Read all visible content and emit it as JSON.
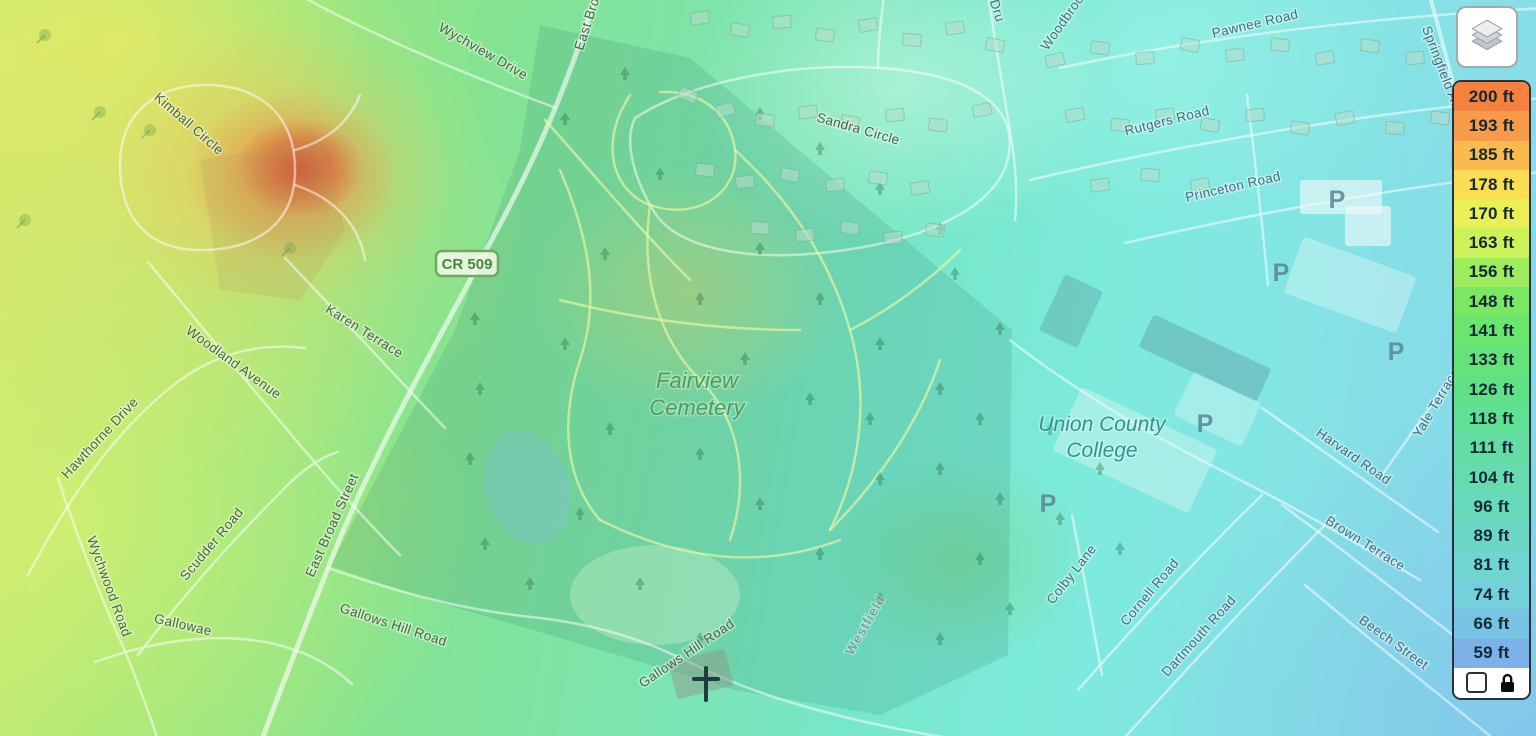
{
  "legend": {
    "unit": "ft",
    "items": [
      {
        "label": "200 ft",
        "color": "#f5813f"
      },
      {
        "label": "193 ft",
        "color": "#f79a49"
      },
      {
        "label": "185 ft",
        "color": "#f9bb4e"
      },
      {
        "label": "178 ft",
        "color": "#fadd52"
      },
      {
        "label": "170 ft",
        "color": "#e9ef55"
      },
      {
        "label": "163 ft",
        "color": "#ccf159"
      },
      {
        "label": "156 ft",
        "color": "#9dec5e"
      },
      {
        "label": "148 ft",
        "color": "#7ce763"
      },
      {
        "label": "141 ft",
        "color": "#6ae56d"
      },
      {
        "label": "133 ft",
        "color": "#63e378"
      },
      {
        "label": "126 ft",
        "color": "#60e187"
      },
      {
        "label": "118 ft",
        "color": "#61df95"
      },
      {
        "label": "111 ft",
        "color": "#63dda3"
      },
      {
        "label": "104 ft",
        "color": "#66dbb0"
      },
      {
        "label": "96 ft",
        "color": "#69d9bc"
      },
      {
        "label": "89 ft",
        "color": "#6dd7c7"
      },
      {
        "label": "81 ft",
        "color": "#70d5d1"
      },
      {
        "label": "74 ft",
        "color": "#74d0da"
      },
      {
        "label": "66 ft",
        "color": "#78c3e3"
      },
      {
        "label": "59 ft",
        "color": "#7cb2e8"
      }
    ],
    "checkbox_checked": false
  },
  "map": {
    "shield": {
      "text": "CR 509",
      "x": 467,
      "y": 264
    },
    "road_labels": [
      {
        "text": "Wychview Drive",
        "x": 481,
        "y": 55,
        "rot": 30,
        "tone": "green"
      },
      {
        "text": "East Broad Street",
        "x": 600,
        "y": -2,
        "rot": -72,
        "tone": "green"
      },
      {
        "text": "East Broad Street",
        "x": 336,
        "y": 527,
        "rot": -66,
        "tone": "green"
      },
      {
        "text": "Kimball Circle",
        "x": 186,
        "y": 127,
        "rot": 41,
        "tone": "green"
      },
      {
        "text": "Karen Terrace",
        "x": 362,
        "y": 335,
        "rot": 32,
        "tone": "green"
      },
      {
        "text": "Woodland Avenue",
        "x": 231,
        "y": 366,
        "rot": 36,
        "tone": "green"
      },
      {
        "text": "Hawthorne Drive",
        "x": 103,
        "y": 441,
        "rot": -47,
        "tone": "green"
      },
      {
        "text": "Wychwood Road",
        "x": 105,
        "y": 588,
        "rot": 70,
        "tone": "green"
      },
      {
        "text": "Scudder Road",
        "x": 215,
        "y": 547,
        "rot": -50,
        "tone": "green"
      },
      {
        "text": "Gallowae",
        "x": 182,
        "y": 629,
        "rot": 13,
        "tone": "green"
      },
      {
        "text": "Gallows Hill Road",
        "x": 392,
        "y": 629,
        "rot": 18,
        "tone": "green"
      },
      {
        "text": "Gallows Hill Road",
        "x": 689,
        "y": 657,
        "rot": -34,
        "tone": "green"
      },
      {
        "text": "Sandra Circle",
        "x": 857,
        "y": 133,
        "rot": 16,
        "tone": "green"
      },
      {
        "text": "Dru",
        "x": 993,
        "y": 12,
        "rot": 72,
        "tone": "cyan"
      },
      {
        "text": "Woodbrook",
        "x": 1068,
        "y": 22,
        "rot": -55,
        "tone": "cyan"
      },
      {
        "text": "Pawnee Road",
        "x": 1256,
        "y": 28,
        "rot": -13,
        "tone": "cyan"
      },
      {
        "text": "Rutgers Road",
        "x": 1168,
        "y": 125,
        "rot": -14,
        "tone": "cyan"
      },
      {
        "text": "Princeton Road",
        "x": 1234,
        "y": 191,
        "rot": -13,
        "tone": "cyan"
      },
      {
        "text": "Springfield Avenue",
        "x": 1443,
        "y": 83,
        "rot": 69,
        "tone": "cyan"
      },
      {
        "text": "Colby Lane",
        "x": 1075,
        "y": 577,
        "rot": -52,
        "tone": "cyan"
      },
      {
        "text": "Cornell Road",
        "x": 1153,
        "y": 595,
        "rot": -50,
        "tone": "cyan"
      },
      {
        "text": "Dartmouth Road",
        "x": 1202,
        "y": 639,
        "rot": -48,
        "tone": "cyan"
      },
      {
        "text": "Brown Terrace",
        "x": 1363,
        "y": 547,
        "rot": 32,
        "tone": "cyan"
      },
      {
        "text": "Beech Street",
        "x": 1391,
        "y": 646,
        "rot": 36,
        "tone": "cyan"
      },
      {
        "text": "Harvard Road",
        "x": 1351,
        "y": 460,
        "rot": 35,
        "tone": "cyan"
      },
      {
        "text": "Yale Terrace",
        "x": 1440,
        "y": 405,
        "rot": -59,
        "tone": "cyan"
      }
    ],
    "place_labels": [
      {
        "lines": [
          "Fairview",
          "Cemetery"
        ],
        "x": 697,
        "y": 388,
        "lh": 27,
        "size": 22,
        "color": "#4f9e55"
      },
      {
        "lines": [
          "Union County",
          "College"
        ],
        "x": 1102,
        "y": 431,
        "lh": 26,
        "size": 21,
        "color": "#2f9591"
      }
    ],
    "city_label": {
      "text": "Westfield",
      "x": 869,
      "y": 627,
      "rot": -60
    },
    "parking": {
      "symbol": "P",
      "positions": [
        [
          1337,
          208
        ],
        [
          1281,
          281
        ],
        [
          1396,
          360
        ],
        [
          1205,
          432
        ],
        [
          1048,
          512
        ]
      ]
    }
  }
}
